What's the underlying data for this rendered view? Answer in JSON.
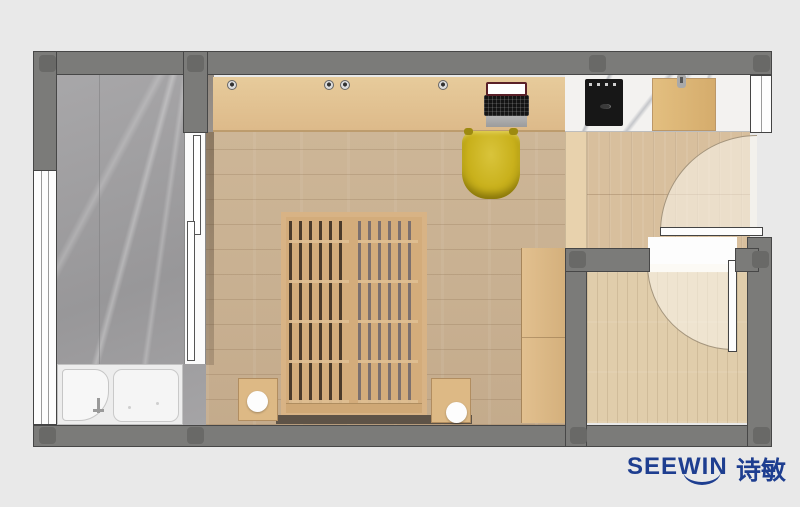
{
  "logo": {
    "brand": "SEEWIN",
    "brand_cn": "诗敏"
  },
  "palette": {
    "page_bg": "#e9e9e9",
    "wall_gray": "#7b7b79",
    "column_gray": "#696967",
    "marble_floor": "#a3a2a4",
    "counter_marble": "#f3f2f0",
    "bedroom_floor": "#c8b092",
    "hall_floor": "#d8bf9d",
    "room_floor": "#e0cdab",
    "wardrobe_wood": "#ddba8a",
    "bed_wood": "#d3ac7b",
    "chair_yellow": "#c9b11c",
    "stove_black": "#171717",
    "fixture_white": "#fdfdfd",
    "brand_blue": "#1e3e90"
  }
}
